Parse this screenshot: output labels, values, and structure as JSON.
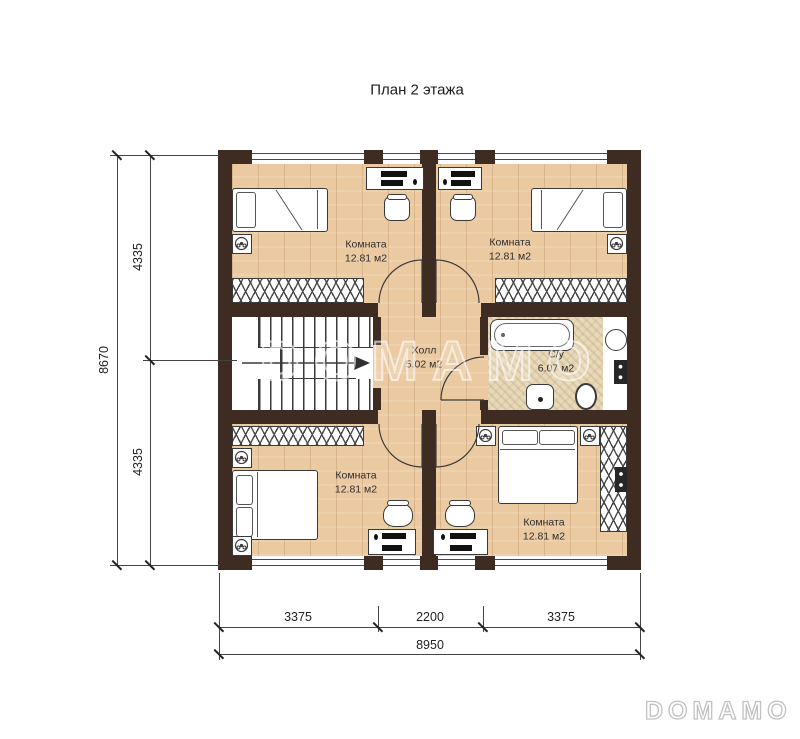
{
  "title": "План 2 этажа",
  "plan": {
    "rooms": {
      "bedroom_tl": {
        "name": "Комната",
        "area": "12.81 м2"
      },
      "bedroom_tr": {
        "name": "Комната",
        "area": "12.81 м2"
      },
      "bedroom_bl": {
        "name": "Комната",
        "area": "12.81 м2"
      },
      "bedroom_br": {
        "name": "Комната",
        "area": "12.81 м2"
      },
      "hall": {
        "name": "Холл",
        "area": "5.02 м2"
      },
      "bathroom": {
        "name": "С/у",
        "area": "6.07 м2"
      }
    }
  },
  "dimensions": {
    "vertical": {
      "total": "8670",
      "top": "4335",
      "bottom": "4335"
    },
    "horizontal": {
      "left": "3375",
      "center": "2200",
      "right": "3375",
      "total": "8950"
    }
  },
  "watermark": {
    "center": "DOMAMO",
    "corner": "DOMAMO"
  },
  "colors": {
    "wall": "#3e2c22",
    "wood_floor": "#ebc9a1",
    "tile_floor": "#e8d9ba",
    "line": "#3a3a3a"
  }
}
